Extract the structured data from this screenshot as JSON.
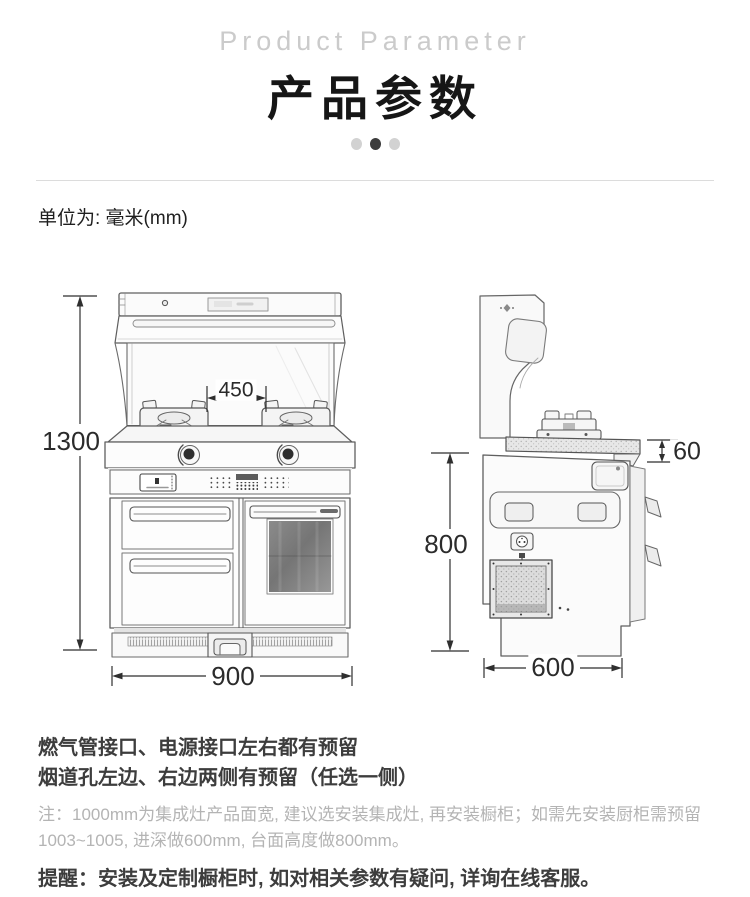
{
  "header": {
    "subtitle": "Product Parameter",
    "title": "产品参数"
  },
  "carousel": {
    "count": 3,
    "active_index": 1
  },
  "unit_note": "单位为: 毫米(mm)",
  "dimensions": {
    "front_height": "1300",
    "burner_spacing": "450",
    "front_width": "900",
    "counter_thickness": "60",
    "body_height": "800",
    "depth": "600"
  },
  "notes": {
    "line1": "燃气管接口、电源接口左右都有预留",
    "line2": "烟道孔左边、右边两侧有预留（任选一侧）",
    "note": "注：1000mm为集成灶产品面宽, 建议选安装集成灶, 再安装橱柜；如需先安装厨柜需预留1003~1005, 进深做600mm, 台面高度做800mm。",
    "reminder": "提醒：安装及定制橱柜时, 如对相关参数有疑问, 详询在线客服。"
  },
  "colors": {
    "title": "#161616",
    "subtitle": "#cbcbcb",
    "dark_text": "#3d3d3d",
    "gray_note": "#b4b4b4",
    "sketch_line": "#5f5f5f",
    "dimension_line": "#2f2f2f"
  }
}
